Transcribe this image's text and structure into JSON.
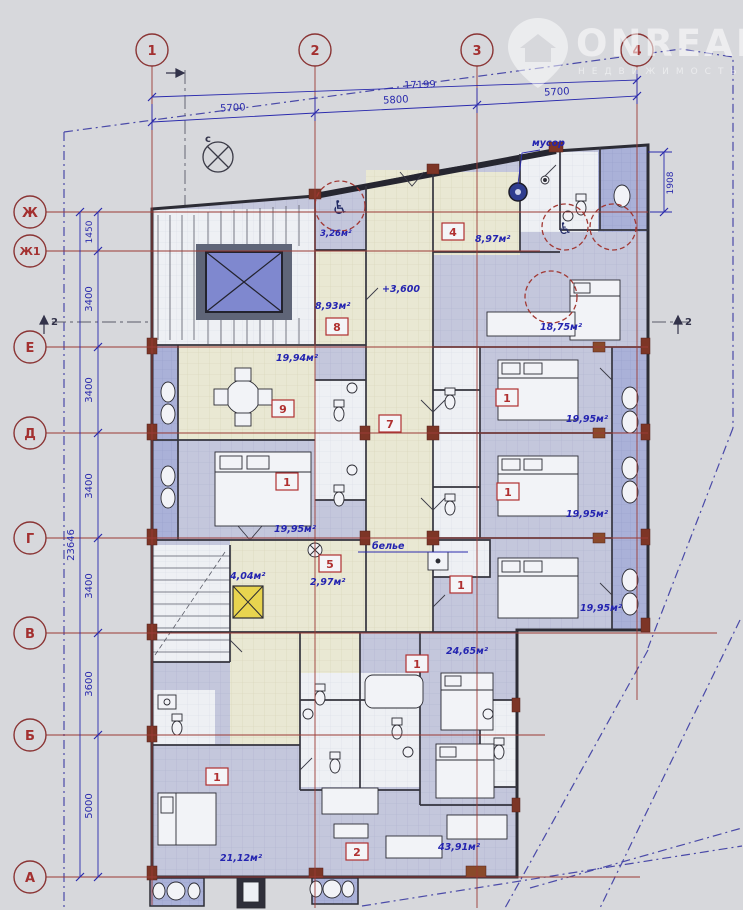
{
  "watermark": {
    "brand": "ONREALT",
    "subtitle": "НЕДВИЖИМОСТЬ"
  },
  "north": {
    "label": "с"
  },
  "axes": {
    "vertical": [
      "1",
      "2",
      "3",
      "4"
    ],
    "horizontal": [
      "Ж",
      "Ж1",
      "Е",
      "Д",
      "Г",
      "В",
      "Б",
      "А"
    ]
  },
  "dims": {
    "top_total": "17199",
    "top": [
      "5700",
      "5800",
      "5700"
    ],
    "left": [
      "1450",
      "3400",
      "3400",
      "3400",
      "3400",
      "3600",
      "5000"
    ],
    "left_total": "23646",
    "right": "1908"
  },
  "sections": {
    "left": "2",
    "right": "2"
  },
  "labels": {
    "garbage": "мусор",
    "linen": "белье",
    "elevation": "+3,600"
  },
  "areas": {
    "wc_ada": "3,26м²",
    "hall8": "8,93м²",
    "room4": "8,97м²",
    "kitchen9": "19,94м²",
    "studio_right": "18,75м²",
    "bedroom_left": "19,95м²",
    "bedroom_r1": "19,95м²",
    "bedroom_r2": "19,95м²",
    "bedroom_r3": "19,95м²",
    "hall_lower": "4,04м²",
    "wc5": "2,97м²",
    "bedroom_2465": "24,65м²",
    "bedroom_2112": "21,12м²",
    "living_4391": "43,91м²"
  },
  "rooms": {
    "tags": [
      "4",
      "8",
      "9",
      "7",
      "5",
      "1",
      "1",
      "1",
      "1",
      "1",
      "1",
      "2"
    ]
  },
  "colors": {
    "axis_red": "#9b3a35",
    "dim_blue": "#2a2aad",
    "corridor_beige": "#e9e8d3",
    "room_blue": "#c4c7dc",
    "balcony_blue": "#aab1d8",
    "shaft_yellow": "#e8d44f",
    "wall_dark": "#2c2c35"
  }
}
